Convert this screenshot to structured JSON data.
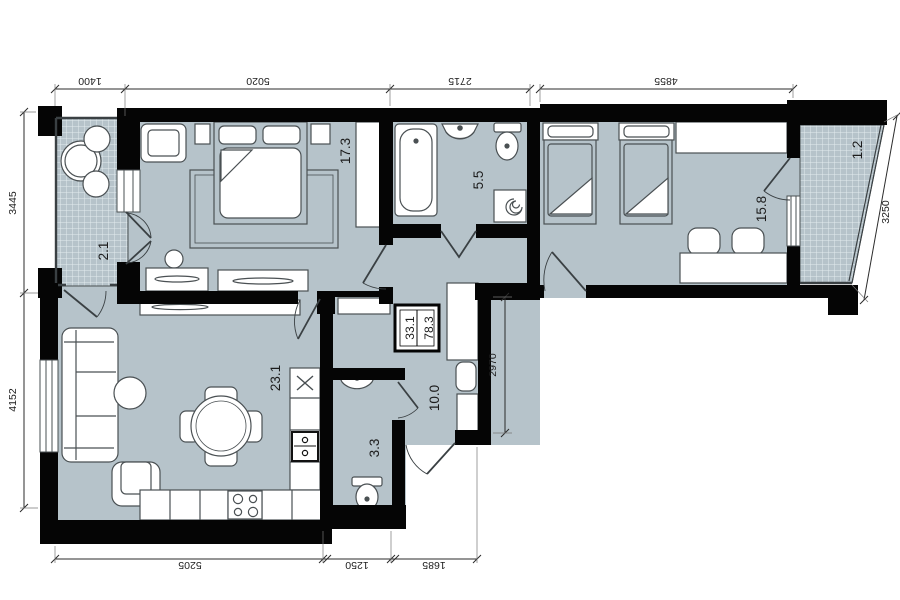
{
  "plan_title": "Two-bedroom apartment floor plan",
  "colors": {
    "wall": "#050505",
    "room_fill": "#b6c3ca",
    "background": "#ffffff",
    "furniture_line": "#4a5053"
  },
  "areas": {
    "balcony_left": "2.1",
    "bedroom_main": "17.3",
    "bathroom": "5.5",
    "bedroom_second": "15.8",
    "balcony_right": "1.2",
    "living_kitchen": "23.1",
    "hallway": "10.0",
    "wc": "3.3"
  },
  "summary": {
    "living_area": "33.1",
    "total_area": "78.3"
  },
  "dimensions": {
    "top_balcony": "1400",
    "top_bedroom": "5020",
    "top_bathroom": "2715",
    "top_bedroom2": "4855",
    "left_upper": "3445",
    "left_lower": "4152",
    "right_balcony": "3250",
    "bottom_living": "5205",
    "bottom_wc": "1250",
    "bottom_hall": "1685",
    "hall_depth": "2970"
  }
}
